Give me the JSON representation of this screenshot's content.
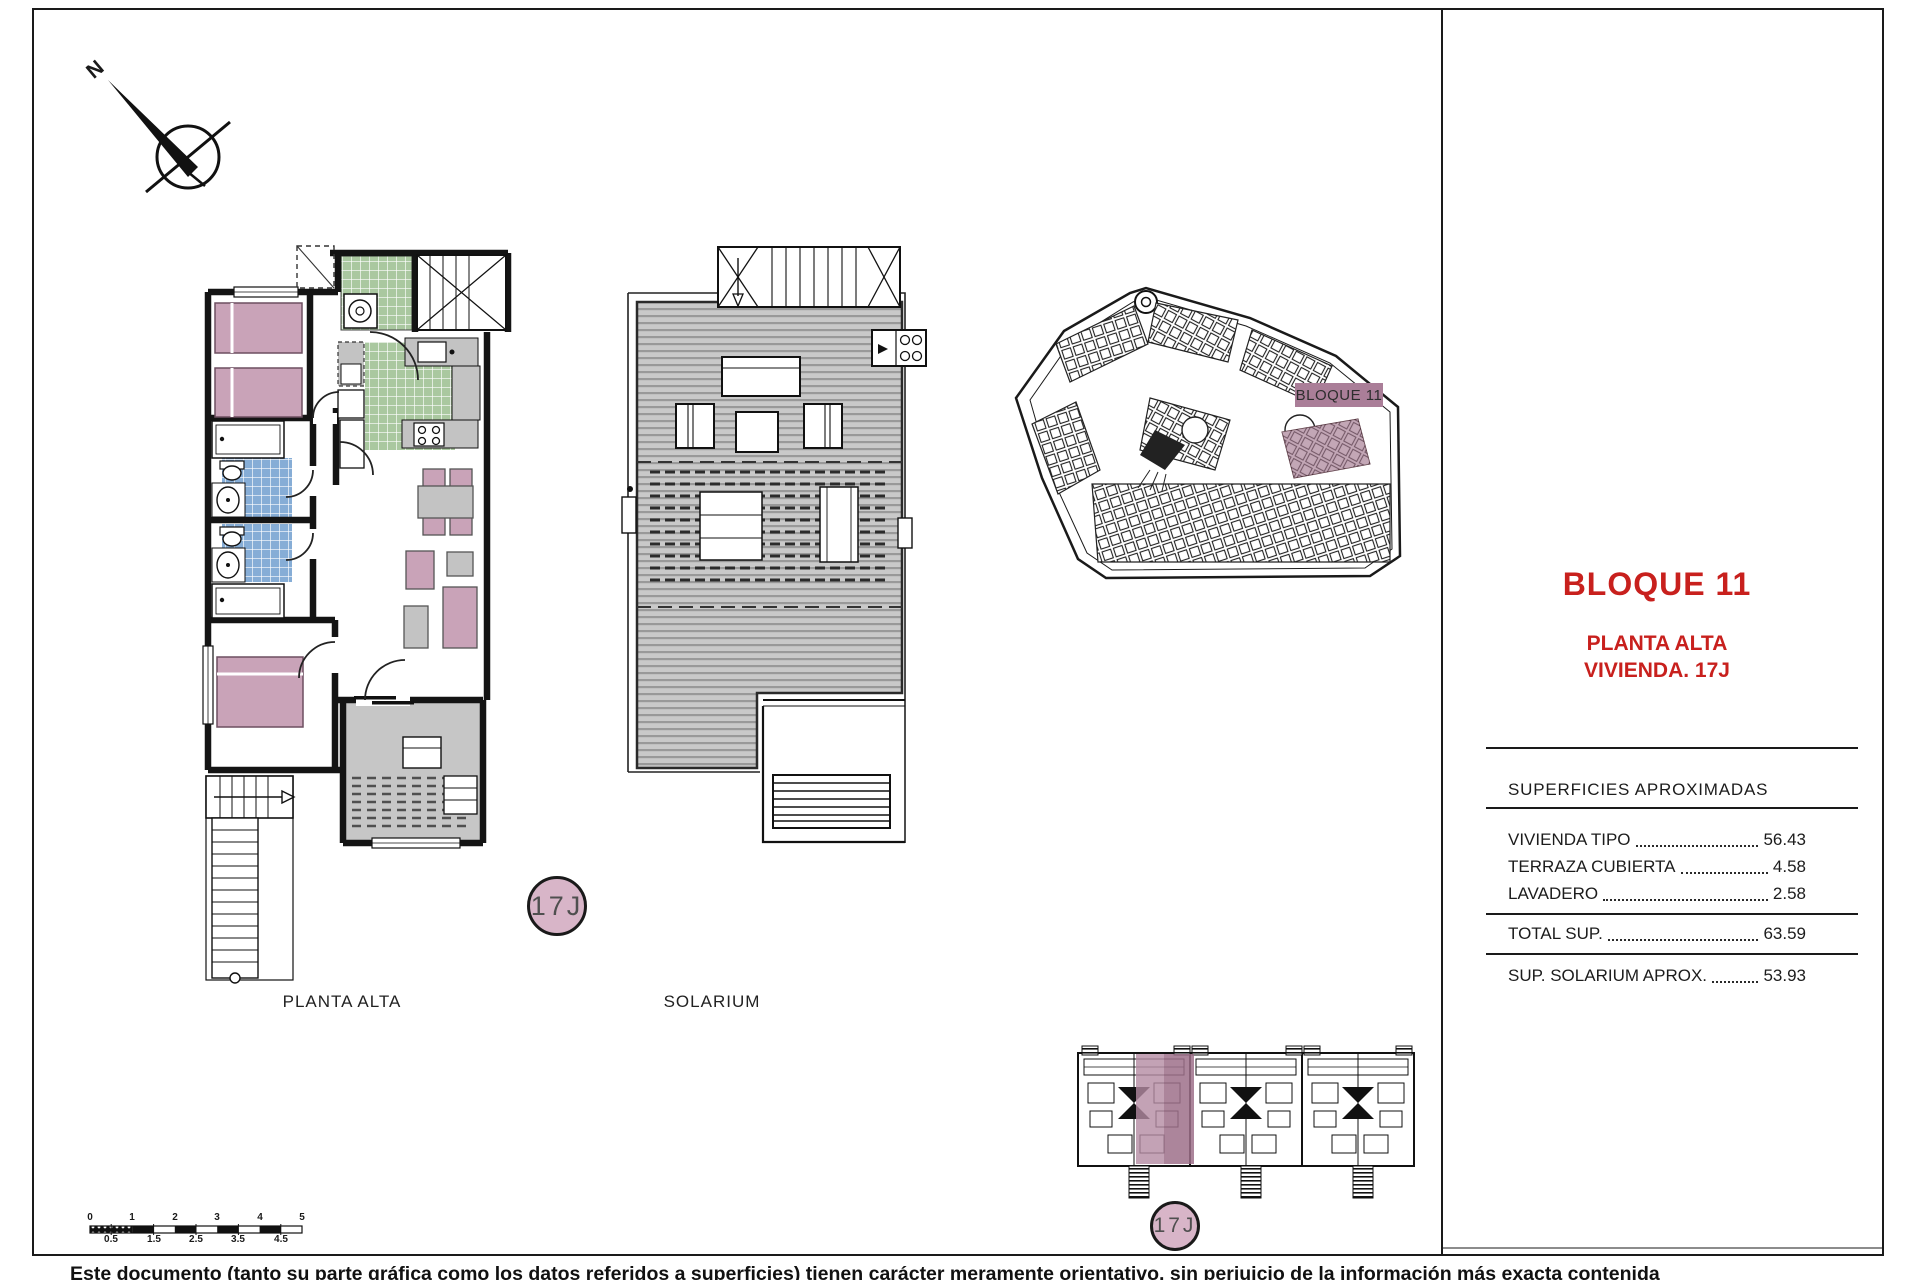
{
  "compass": {
    "label": "N"
  },
  "plans": {
    "left_label": "PLANTA ALTA",
    "middle_label": "SOLARIUM",
    "unit_badge": "17J"
  },
  "site_plan": {
    "block_label": "BLOQUE 11"
  },
  "title_block": {
    "block_title": "BLOQUE 11",
    "floor_label": "PLANTA ALTA",
    "unit_label": "VIVIENDA. 17J",
    "surfaces_title": "SUPERFICIES APROXIMADAS",
    "rows": [
      {
        "label": "VIVIENDA TIPO",
        "value": "56.43"
      },
      {
        "label": "TERRAZA CUBIERTA",
        "value": "4.58"
      },
      {
        "label": "LAVADERO",
        "value": "2.58"
      }
    ],
    "total_row": {
      "label": "TOTAL SUP.",
      "value": "63.59"
    },
    "solarium_row": {
      "label": "SUP. SOLARIUM APROX.",
      "value": "53.93"
    }
  },
  "scale_bar": {
    "top_labels": [
      "0",
      "1",
      "2",
      "3",
      "4",
      "5"
    ],
    "bottom_labels": [
      "0.5",
      "1.5",
      "2.5",
      "3.5",
      "4.5"
    ]
  },
  "footer": {
    "disclaimer": "Este documento (tanto su parte gráfica como los datos referidos a superficies) tienen carácter meramente orientativo, sin perjuicio de la información más exacta contenida"
  },
  "colors": {
    "accent_red": "#c8201d",
    "highlight_mauve": "#a3788f",
    "furniture_pink": "#c9a3b8",
    "kitchen_green": "#aac8a0",
    "bath_blue": "#86add6"
  }
}
